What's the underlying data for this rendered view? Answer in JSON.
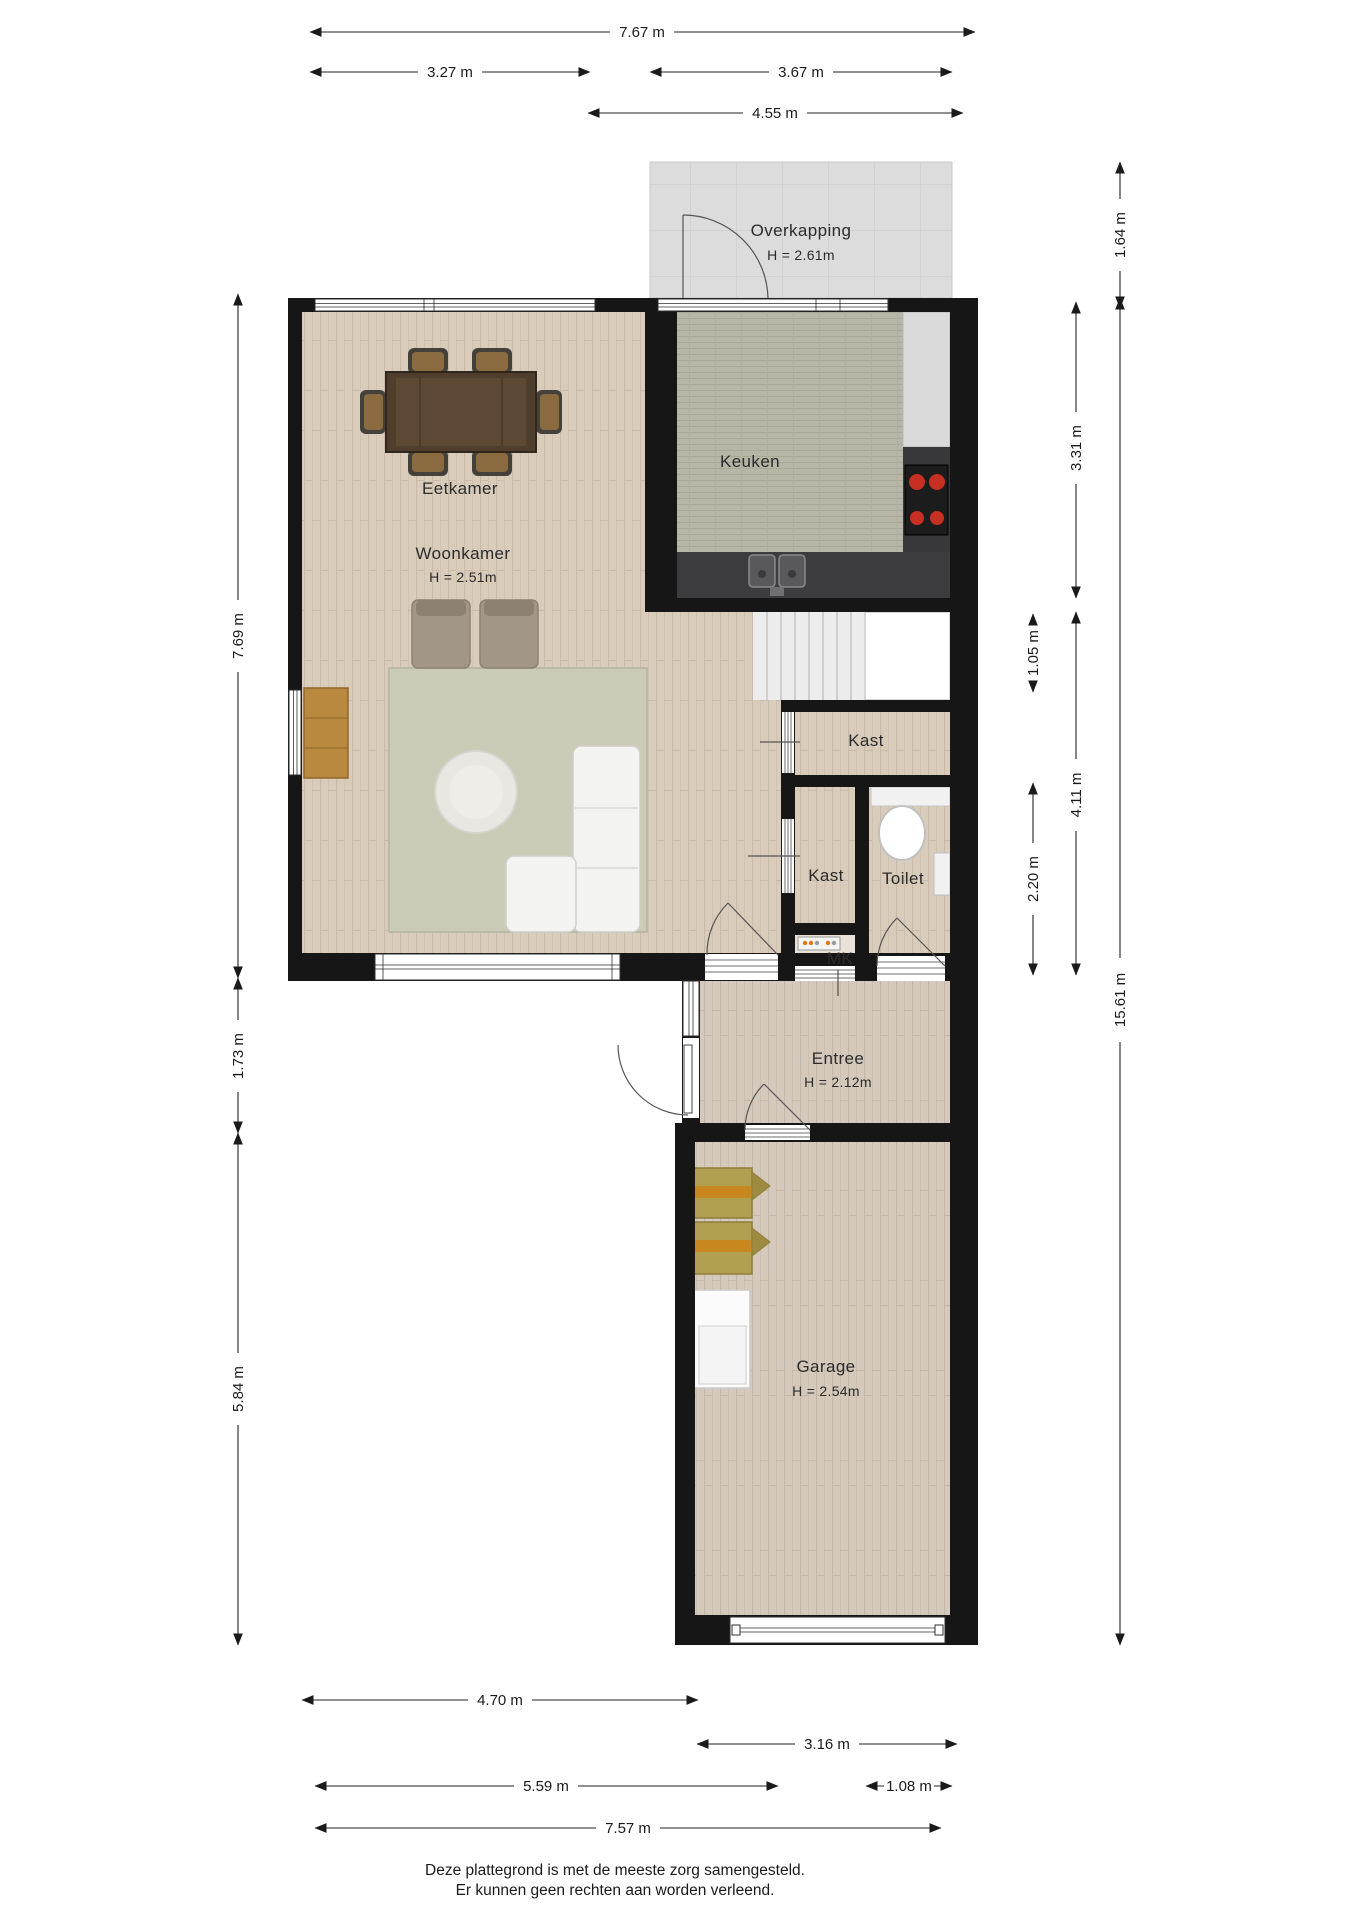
{
  "rooms": {
    "overkapping": {
      "name": "Overkapping",
      "height": "H = 2.61m"
    },
    "keuken": {
      "name": "Keuken"
    },
    "eetkamer": {
      "name": "Eetkamer"
    },
    "woonkamer": {
      "name": "Woonkamer",
      "height": "H = 2.51m"
    },
    "kast_boven": {
      "name": "Kast"
    },
    "kast_onder": {
      "name": "Kast"
    },
    "toilet": {
      "name": "Toilet"
    },
    "meterkast": {
      "name": "MK"
    },
    "entree": {
      "name": "Entree",
      "height": "H = 2.12m"
    },
    "garage": {
      "name": "Garage",
      "height": "H = 2.54m"
    }
  },
  "dimensions": {
    "top_total": "7.67 m",
    "top_left": "3.27 m",
    "top_right": "3.67 m",
    "top_overkapping": "4.55 m",
    "right_overkapping": "1.64 m",
    "right_keuken": "3.31 m",
    "right_trap": "1.05 m",
    "right_hal": "4.11 m",
    "right_toilet": "2.20 m",
    "right_total": "15.61 m",
    "left_woonkamer": "7.69 m",
    "left_tussen": "1.73 m",
    "left_garage": "5.84 m",
    "bottom_tuin": "4.70 m",
    "bottom_garage": "3.16 m",
    "bottom_voor": "5.59 m",
    "bottom_pad": "1.08 m",
    "bottom_total": "7.57 m"
  },
  "footer": {
    "line1": "Deze plattegrond is met de meeste zorg samengesteld.",
    "line2": "Er kunnen geen rechten aan worden verleend."
  },
  "colors": {
    "wall": "#161616",
    "wood_living": "#d9ccbb",
    "wood_hall": "#d4c9ba",
    "kitchen_tile": "#b8b6a7",
    "overkapping_tile": "#dcdcdc",
    "counter": "#3c3c3e",
    "burner_red": "#c62f22"
  }
}
